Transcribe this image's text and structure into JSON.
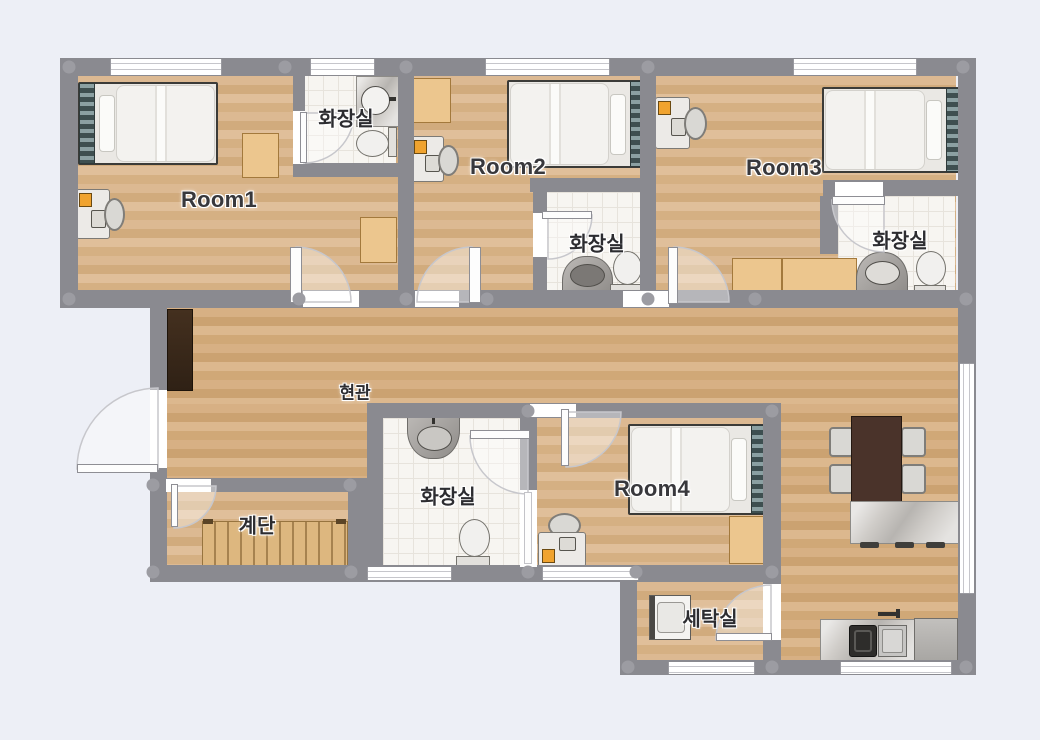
{
  "plan": {
    "colors": {
      "background": "#edeff6",
      "wall": "#8a8a90",
      "wood_floor": "#d8b38a",
      "tile_floor": "#f7f5f1",
      "furniture_wood": "#ecc68e",
      "headboard_teal": "#54666a",
      "desk_accent_orange": "#f0a32f",
      "stairs_wood": "#ddb77f",
      "dining_table": "#4a332a"
    },
    "labels": {
      "room1": "Room1",
      "room2": "Room2",
      "room3": "Room3",
      "room4": "Room4",
      "bath1": "화장실",
      "bath2": "화장실",
      "bath3": "화장실",
      "bath4": "화장실",
      "entrance": "현관",
      "stairs": "계단",
      "laundry": "세탁실"
    }
  }
}
